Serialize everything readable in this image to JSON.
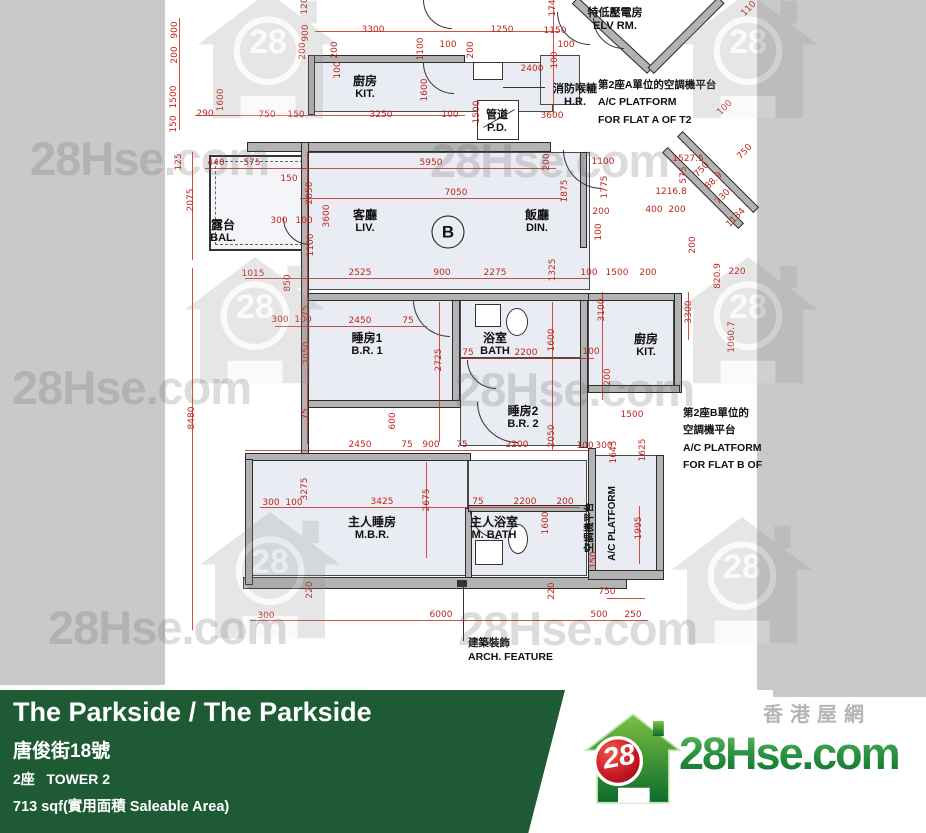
{
  "watermark": {
    "text": "28Hse.com",
    "logo_number": "28"
  },
  "footer": {
    "title": "The Parkside / The Parkside",
    "address": "唐俊街18號",
    "tower": "2座   TOWER 2",
    "area": "713 sqf(實用面積 Saleable Area)",
    "brand": {
      "tagline": "香港屋網",
      "wordmark": "28Hse.com",
      "badge": "28"
    },
    "accent_green": "#1E5B35"
  },
  "colors": {
    "dim_red": "#C2251C",
    "bg_gray": "#C9C9C9",
    "room_fill": "#E9ECF2",
    "logo_green": "#2E9643",
    "logo_red": "#C61621"
  },
  "plan": {
    "unit_label": "B",
    "rooms": {
      "kit_top": {
        "cn": "廚房",
        "en": "KIT."
      },
      "bal": {
        "cn": "露台",
        "en": "BAL."
      },
      "liv": {
        "cn": "客廳",
        "en": "LIV."
      },
      "din": {
        "cn": "飯廳",
        "en": "DIN."
      },
      "br1": {
        "cn": "睡房1",
        "en": "B.R. 1"
      },
      "bath": {
        "cn": "浴室",
        "en": "BATH"
      },
      "br2": {
        "cn": "睡房2",
        "en": "B.R. 2"
      },
      "kit_right": {
        "cn": "廚房",
        "en": "KIT."
      },
      "mbr": {
        "cn": "主人睡房",
        "en": "M.B.R."
      },
      "mbath": {
        "cn": "主人浴室",
        "en": "M. BATH"
      },
      "pd": {
        "cn": "管道",
        "en": "P.D."
      },
      "hr": {
        "cn": "消防喉轆",
        "en": "H.R."
      },
      "elv": {
        "cn": "特低壓電房",
        "en": "ELV RM."
      }
    },
    "annotations": {
      "ac_a": [
        "第2座A單位的空調機平台",
        "A/C PLATFORM",
        "FOR FLAT A OF T2"
      ],
      "ac_b": [
        "第2座B單位的",
        "空調機平台",
        "A/C PLATFORM",
        "FOR FLAT B OF"
      ],
      "ac_vert_cn": "空調機平台",
      "ac_vert_en": "A/C PLATFORM",
      "arch": [
        "建築裝飾",
        "ARCH. FEATURE"
      ]
    },
    "dims": [
      {
        "t": "900",
        "x": 10,
        "y": 30,
        "r": "v"
      },
      {
        "t": "200",
        "x": 10,
        "y": 55,
        "r": "v"
      },
      {
        "t": "1500",
        "x": 9,
        "y": 97,
        "r": "v"
      },
      {
        "t": "150",
        "x": 9,
        "y": 124,
        "r": "v"
      },
      {
        "t": "1600",
        "x": 56,
        "y": 100,
        "r": "v"
      },
      {
        "t": "290",
        "x": 40,
        "y": 114
      },
      {
        "t": "750",
        "x": 102,
        "y": 115
      },
      {
        "t": "150",
        "x": 131,
        "y": 115
      },
      {
        "t": "3250",
        "x": 216,
        "y": 115
      },
      {
        "t": "100",
        "x": 285,
        "y": 115
      },
      {
        "t": "3300",
        "x": 208,
        "y": 30
      },
      {
        "t": "1250",
        "x": 337,
        "y": 30
      },
      {
        "t": "1150",
        "x": 390,
        "y": 31
      },
      {
        "t": "120",
        "x": 140,
        "y": 6,
        "r": "v"
      },
      {
        "t": "900",
        "x": 141,
        "y": 33,
        "r": "v"
      },
      {
        "t": "200",
        "x": 138,
        "y": 51,
        "r": "v"
      },
      {
        "t": "100",
        "x": 173,
        "y": 70,
        "r": "v"
      },
      {
        "t": "200",
        "x": 170,
        "y": 50,
        "r": "v"
      },
      {
        "t": "1100",
        "x": 256,
        "y": 49,
        "r": "v"
      },
      {
        "t": "200",
        "x": 306,
        "y": 50,
        "r": "v"
      },
      {
        "t": "1600",
        "x": 260,
        "y": 90,
        "r": "v"
      },
      {
        "t": "1500",
        "x": 312,
        "y": 112,
        "r": "v"
      },
      {
        "t": "100",
        "x": 283,
        "y": 45
      },
      {
        "t": "2400",
        "x": 367,
        "y": 69
      },
      {
        "t": "100",
        "x": 401,
        "y": 45
      },
      {
        "t": "100",
        "x": 390,
        "y": 60,
        "r": "v"
      },
      {
        "t": "174",
        "x": 388,
        "y": 8,
        "r": "v"
      },
      {
        "t": "3600",
        "x": 387,
        "y": 116
      },
      {
        "t": "125",
        "x": 14,
        "y": 162,
        "r": "v"
      },
      {
        "t": "2075",
        "x": 26,
        "y": 200,
        "r": "v"
      },
      {
        "t": "440",
        "x": 51,
        "y": 163
      },
      {
        "t": "575",
        "x": 87,
        "y": 163
      },
      {
        "t": "150",
        "x": 124,
        "y": 179
      },
      {
        "t": "5950",
        "x": 266,
        "y": 163
      },
      {
        "t": "7050",
        "x": 291,
        "y": 193
      },
      {
        "t": "200",
        "x": 382,
        "y": 162,
        "r": "v"
      },
      {
        "t": "1875",
        "x": 400,
        "y": 191,
        "r": "v"
      },
      {
        "t": "2050",
        "x": 145,
        "y": 193,
        "r": "v"
      },
      {
        "t": "3600",
        "x": 162,
        "y": 216,
        "r": "v"
      },
      {
        "t": "300",
        "x": 114,
        "y": 221
      },
      {
        "t": "100",
        "x": 139,
        "y": 221
      },
      {
        "t": "1100",
        "x": 146,
        "y": 245,
        "r": "v"
      },
      {
        "t": "1015",
        "x": 88,
        "y": 274
      },
      {
        "t": "850",
        "x": 123,
        "y": 283,
        "r": "v"
      },
      {
        "t": "2525",
        "x": 195,
        "y": 273
      },
      {
        "t": "900",
        "x": 277,
        "y": 273
      },
      {
        "t": "2275",
        "x": 330,
        "y": 273
      },
      {
        "t": "1325",
        "x": 388,
        "y": 270,
        "r": "v"
      },
      {
        "t": "1100",
        "x": 438,
        "y": 162
      },
      {
        "t": "1775",
        "x": 440,
        "y": 187,
        "r": "v"
      },
      {
        "t": "1527.5",
        "x": 523,
        "y": 159
      },
      {
        "t": "1216.8",
        "x": 506,
        "y": 192
      },
      {
        "t": "400",
        "x": 489,
        "y": 210
      },
      {
        "t": "200",
        "x": 512,
        "y": 210
      },
      {
        "t": "200",
        "x": 436,
        "y": 212
      },
      {
        "t": "100",
        "x": 434,
        "y": 232,
        "r": "v"
      },
      {
        "t": "200",
        "x": 528,
        "y": 245,
        "r": "v"
      },
      {
        "t": "100",
        "x": 424,
        "y": 273
      },
      {
        "t": "1500",
        "x": 452,
        "y": 273
      },
      {
        "t": "200",
        "x": 483,
        "y": 273
      },
      {
        "t": "750",
        "x": 537,
        "y": 170,
        "r": "d"
      },
      {
        "t": "575",
        "x": 519,
        "y": 175,
        "r": "v"
      },
      {
        "t": "88.9",
        "x": 549,
        "y": 181,
        "r": "d"
      },
      {
        "t": "730",
        "x": 558,
        "y": 197,
        "r": "d"
      },
      {
        "t": "1134",
        "x": 571,
        "y": 218,
        "r": "d"
      },
      {
        "t": "100",
        "x": 560,
        "y": 108,
        "r": "d"
      },
      {
        "t": "110",
        "x": 584,
        "y": 9,
        "r": "d"
      },
      {
        "t": "750",
        "x": 580,
        "y": 152,
        "r": "d"
      },
      {
        "t": "820.9",
        "x": 553,
        "y": 276,
        "r": "v"
      },
      {
        "t": "220",
        "x": 572,
        "y": 272
      },
      {
        "t": "3300",
        "x": 524,
        "y": 312,
        "r": "v"
      },
      {
        "t": "1060.7",
        "x": 567,
        "y": 337,
        "r": "v"
      },
      {
        "t": "300",
        "x": 115,
        "y": 320
      },
      {
        "t": "100",
        "x": 138,
        "y": 320
      },
      {
        "t": "2450",
        "x": 195,
        "y": 321
      },
      {
        "t": "75",
        "x": 243,
        "y": 321
      },
      {
        "t": "75",
        "x": 141,
        "y": 311,
        "r": "v"
      },
      {
        "t": "2050",
        "x": 142,
        "y": 353,
        "r": "v"
      },
      {
        "t": "75",
        "x": 141,
        "y": 414,
        "r": "v"
      },
      {
        "t": "600",
        "x": 228,
        "y": 421,
        "r": "v"
      },
      {
        "t": "2725",
        "x": 274,
        "y": 360,
        "r": "v"
      },
      {
        "t": "75",
        "x": 303,
        "y": 353
      },
      {
        "t": "2200",
        "x": 361,
        "y": 353
      },
      {
        "t": "1600",
        "x": 387,
        "y": 340,
        "r": "v"
      },
      {
        "t": "100",
        "x": 426,
        "y": 352
      },
      {
        "t": "3100",
        "x": 437,
        "y": 310,
        "r": "v"
      },
      {
        "t": "200",
        "x": 443,
        "y": 377,
        "r": "v"
      },
      {
        "t": "2050",
        "x": 387,
        "y": 436,
        "r": "v"
      },
      {
        "t": "2450",
        "x": 195,
        "y": 445
      },
      {
        "t": "75",
        "x": 242,
        "y": 445
      },
      {
        "t": "900",
        "x": 266,
        "y": 445
      },
      {
        "t": "75",
        "x": 297,
        "y": 445
      },
      {
        "t": "2200",
        "x": 352,
        "y": 445
      },
      {
        "t": "100",
        "x": 420,
        "y": 446
      },
      {
        "t": "300",
        "x": 439,
        "y": 446
      },
      {
        "t": "1645",
        "x": 449,
        "y": 452,
        "r": "v"
      },
      {
        "t": "1625",
        "x": 478,
        "y": 450,
        "r": "v"
      },
      {
        "t": "1500",
        "x": 467,
        "y": 415
      },
      {
        "t": "3275",
        "x": 140,
        "y": 489,
        "r": "v"
      },
      {
        "t": "300",
        "x": 106,
        "y": 503
      },
      {
        "t": "100",
        "x": 129,
        "y": 503
      },
      {
        "t": "3425",
        "x": 217,
        "y": 502
      },
      {
        "t": "2675",
        "x": 262,
        "y": 500,
        "r": "v"
      },
      {
        "t": "75",
        "x": 313,
        "y": 502
      },
      {
        "t": "2200",
        "x": 360,
        "y": 502
      },
      {
        "t": "200",
        "x": 400,
        "y": 502
      },
      {
        "t": "1600",
        "x": 381,
        "y": 523,
        "r": "v"
      },
      {
        "t": "1995",
        "x": 474,
        "y": 528,
        "r": "v"
      },
      {
        "t": "150",
        "x": 429,
        "y": 560,
        "r": "v"
      },
      {
        "t": "220",
        "x": 145,
        "y": 590,
        "r": "v"
      },
      {
        "t": "220",
        "x": 387,
        "y": 591,
        "r": "v"
      },
      {
        "t": "750",
        "x": 442,
        "y": 592
      },
      {
        "t": "300",
        "x": 101,
        "y": 616
      },
      {
        "t": "6000",
        "x": 276,
        "y": 615
      },
      {
        "t": "500",
        "x": 434,
        "y": 615
      },
      {
        "t": "250",
        "x": 468,
        "y": 615
      },
      {
        "t": "8480",
        "x": 27,
        "y": 418,
        "r": "v"
      }
    ]
  }
}
